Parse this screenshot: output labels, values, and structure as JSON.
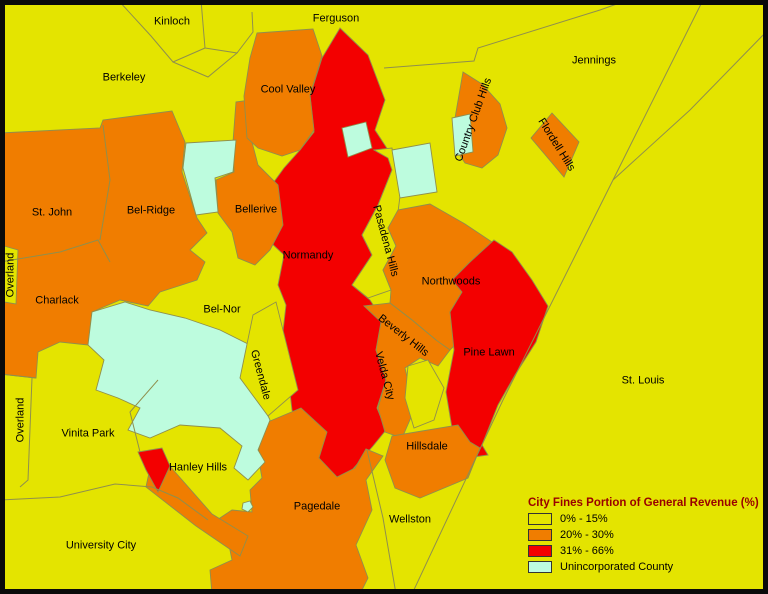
{
  "palette": {
    "low": "#E4E400",
    "mid": "#F07D00",
    "high": "#F30000",
    "unincorporated": "#BDFCDE",
    "line": "#8F8F4D",
    "frame": "#0A0A0A",
    "label_text": "#000000",
    "legend_title_color": "#990000"
  },
  "legend": {
    "title": "City Fines Portion of General Revenue (%)",
    "items": [
      {
        "label": "0% - 15%",
        "category": "low"
      },
      {
        "label": "20% - 30%",
        "category": "mid"
      },
      {
        "label": "31% - 66%",
        "category": "high"
      },
      {
        "label": "Unincorporated County",
        "category": "unincorporated"
      }
    ]
  },
  "map": {
    "regions": [
      {
        "id": "normandy",
        "category": "high",
        "points": "340,28 368,55 385,100 375,130 390,153 392,170 378,205 362,235 372,255 352,285 370,300 383,320 376,350 386,380 377,408 386,430 373,446 352,470 334,480 316,462 302,438 292,410 288,375 282,340 286,305 278,285 284,255 268,240 262,228 278,212 268,190 284,168 300,150 314,132 310,96 322,58"
      },
      {
        "id": "pasadena-hills",
        "category": "low",
        "points": "374,150 392,148 400,196 398,212 388,228 396,246 383,270 391,290 368,298 352,285 372,255 362,235 378,205 392,170 388,158"
      },
      {
        "id": "northwoods",
        "category": "mid",
        "points": "398,210 430,204 465,224 495,244 470,262 452,280 462,292 450,312 455,345 448,352 436,340 412,320 390,303 391,290 383,270 396,246 388,228"
      },
      {
        "id": "pine-lawn",
        "category": "high",
        "points": "494,240 512,252 532,280 548,306 536,342 515,375 498,405 482,445 488,455 466,458 452,428 446,392 454,350 450,312 462,292 452,280 470,262"
      },
      {
        "id": "beverly-hills-velda-city",
        "category": "mid",
        "points": "364,306 390,303 412,320 436,340 450,350 438,366 420,358 405,368 410,390 412,415 402,438 385,432 378,408 386,380 376,350 381,322"
      },
      {
        "id": "velda-village-patch",
        "category": "low",
        "points": "408,366 428,360 444,388 434,420 414,428 405,398"
      },
      {
        "id": "hillsdale",
        "category": "mid",
        "points": "392,436 458,425 470,442 480,448 468,478 420,498 395,488 385,460"
      },
      {
        "id": "pagedale",
        "category": "mid",
        "points": "263,424 301,408 327,432 319,458 337,477 355,468 366,449 383,456 366,480 372,510 356,545 368,578 360,594 212,594 210,570 232,560 228,540 205,528 232,510 252,512 250,490 262,478 258,455"
      },
      {
        "id": "pagedale-west-arm",
        "category": "mid",
        "points": "150,468 168,464 212,514 248,536 240,556 196,526 146,487"
      },
      {
        "id": "hanley-red-sliver",
        "category": "high",
        "points": "138,452 162,448 170,466 158,492 146,470"
      },
      {
        "id": "st-john-bel-ridge-charlack",
        "category": "mid",
        "points": "0,133 100,128 103,120 172,111 185,142 182,172 197,218 207,233 190,250 205,262 197,280 160,292 148,306 120,300 92,312 88,345 60,342 38,352 36,378 0,374"
      },
      {
        "id": "overland-strip",
        "category": "low",
        "points": "4,246 18,250 16,304 4,302"
      },
      {
        "id": "bellerive",
        "category": "mid",
        "points": "236,102 266,98 270,135 252,142 258,165 278,185 283,225 270,250 255,265 238,258 232,232 218,213 216,180 234,172 233,142"
      },
      {
        "id": "cool-valley",
        "category": "mid",
        "points": "257,33 313,29 322,56 310,95 314,130 300,150 282,156 258,148 247,138 244,96 250,58"
      },
      {
        "id": "country-club-hills",
        "category": "mid",
        "points": "463,72 482,84 500,104 507,128 498,155 482,168 465,163 456,150 455,118 459,95"
      },
      {
        "id": "flordell-hills",
        "category": "mid",
        "points": "552,113 579,142 564,177 531,138"
      },
      {
        "id": "unincorporated-north",
        "category": "unincorporated",
        "points": "186,143 236,140 233,172 215,178 218,212 196,215 183,168"
      },
      {
        "id": "unincorporated-normandy-hole",
        "category": "unincorporated",
        "points": "342,128 366,122 372,148 348,157"
      },
      {
        "id": "unincorporated-pasadena",
        "category": "unincorporated",
        "points": "392,150 430,143 437,192 400,198"
      },
      {
        "id": "unincorporated-country-club",
        "category": "unincorporated",
        "points": "452,118 470,114 473,152 455,156"
      },
      {
        "id": "unincorporated-central",
        "category": "unincorporated",
        "points": "92,312 125,302 150,310 185,318 220,330 250,345 268,370 258,395 270,420 258,450 265,462 248,480 234,468 242,446 220,428 180,425 150,438 128,430 140,408 118,398 96,390 104,360 88,345"
      },
      {
        "id": "unincorporated-dot",
        "category": "unincorporated",
        "points": "243,503 250,501 253,507 248,512 242,509"
      },
      {
        "id": "greendale",
        "category": "low",
        "points": "253,315 276,302 298,390 268,416 240,378"
      }
    ],
    "lines": [
      {
        "id": "kinloch-boundary-west",
        "d": "M118,0 L151,36 L173,62 L205,48 L201,0"
      },
      {
        "id": "kinloch-boundary-south",
        "d": "M173,62 L208,77 L237,53 L205,48"
      },
      {
        "id": "ferguson-berkeley-boundary",
        "d": "M237,53 L253,32 L252,12"
      },
      {
        "id": "jennings-north-boundary",
        "d": "M384,68 L474,61 L478,48 L600,10 L628,0"
      },
      {
        "id": "st-louis-city-boundary",
        "d": "M703,0 L613,180 L503,400 L412,594"
      },
      {
        "id": "jennings-east-boundary",
        "d": "M768,30 L690,110 L613,180"
      },
      {
        "id": "university-city-boundary",
        "d": "M0,500 L60,497 L115,484 L152,487 L178,498 L208,520"
      },
      {
        "id": "overland-east-boundary",
        "d": "M32,378 L28,480 L20,487"
      },
      {
        "id": "overland-north-boundary",
        "d": "M0,374 L36,378"
      },
      {
        "id": "vinita-park-east-boundary",
        "d": "M158,380 L130,412 L140,452"
      },
      {
        "id": "wellston-east-boundary",
        "d": "M367,450 L383,518 L396,594"
      },
      {
        "id": "st-john-bel-ridge-boundary",
        "d": "M103,125 L110,180 L100,240"
      },
      {
        "id": "charlack-north-boundary",
        "d": "M0,262 L60,252 L98,240 L110,262"
      }
    ],
    "labels": [
      {
        "text": "Kinloch",
        "x": 172,
        "y": 22,
        "rot": 0
      },
      {
        "text": "Ferguson",
        "x": 336,
        "y": 19,
        "rot": 0
      },
      {
        "text": "Berkeley",
        "x": 124,
        "y": 78,
        "rot": 0
      },
      {
        "text": "Cool Valley",
        "x": 288,
        "y": 90,
        "rot": 0
      },
      {
        "text": "Jennings",
        "x": 594,
        "y": 61,
        "rot": 0
      },
      {
        "text": "Country Club Hills",
        "x": 474,
        "y": 120,
        "rot": -70
      },
      {
        "text": "Flordell Hills",
        "x": 556,
        "y": 145,
        "rot": 58
      },
      {
        "text": "St. John",
        "x": 52,
        "y": 213,
        "rot": 0
      },
      {
        "text": "Bel-Ridge",
        "x": 151,
        "y": 211,
        "rot": 0
      },
      {
        "text": "Bellerive",
        "x": 256,
        "y": 210,
        "rot": 0
      },
      {
        "text": "Normandy",
        "x": 308,
        "y": 256,
        "rot": 0
      },
      {
        "text": "Pasadena Hills",
        "x": 385,
        "y": 241,
        "rot": 75
      },
      {
        "text": "Overland",
        "x": 11,
        "y": 275,
        "rot": -90
      },
      {
        "text": "Charlack",
        "x": 57,
        "y": 301,
        "rot": 0
      },
      {
        "text": "Bel-Nor",
        "x": 222,
        "y": 310,
        "rot": 0
      },
      {
        "text": "Greendale",
        "x": 260,
        "y": 375,
        "rot": 75
      },
      {
        "text": "Northwoods",
        "x": 451,
        "y": 282,
        "rot": 0
      },
      {
        "text": "Beverly Hills",
        "x": 403,
        "y": 336,
        "rot": 38
      },
      {
        "text": "Velda City",
        "x": 384,
        "y": 376,
        "rot": 75
      },
      {
        "text": "Pine Lawn",
        "x": 489,
        "y": 353,
        "rot": 0
      },
      {
        "text": "St. Louis",
        "x": 643,
        "y": 381,
        "rot": 0
      },
      {
        "text": "Overland",
        "x": 21,
        "y": 420,
        "rot": -90
      },
      {
        "text": "Vinita Park",
        "x": 88,
        "y": 434,
        "rot": 0
      },
      {
        "text": "Hanley Hills",
        "x": 198,
        "y": 468,
        "rot": 0
      },
      {
        "text": "Hillsdale",
        "x": 427,
        "y": 447,
        "rot": 0
      },
      {
        "text": "Pagedale",
        "x": 317,
        "y": 507,
        "rot": 0
      },
      {
        "text": "Wellston",
        "x": 410,
        "y": 520,
        "rot": 0
      },
      {
        "text": "University City",
        "x": 101,
        "y": 546,
        "rot": 0
      }
    ]
  }
}
